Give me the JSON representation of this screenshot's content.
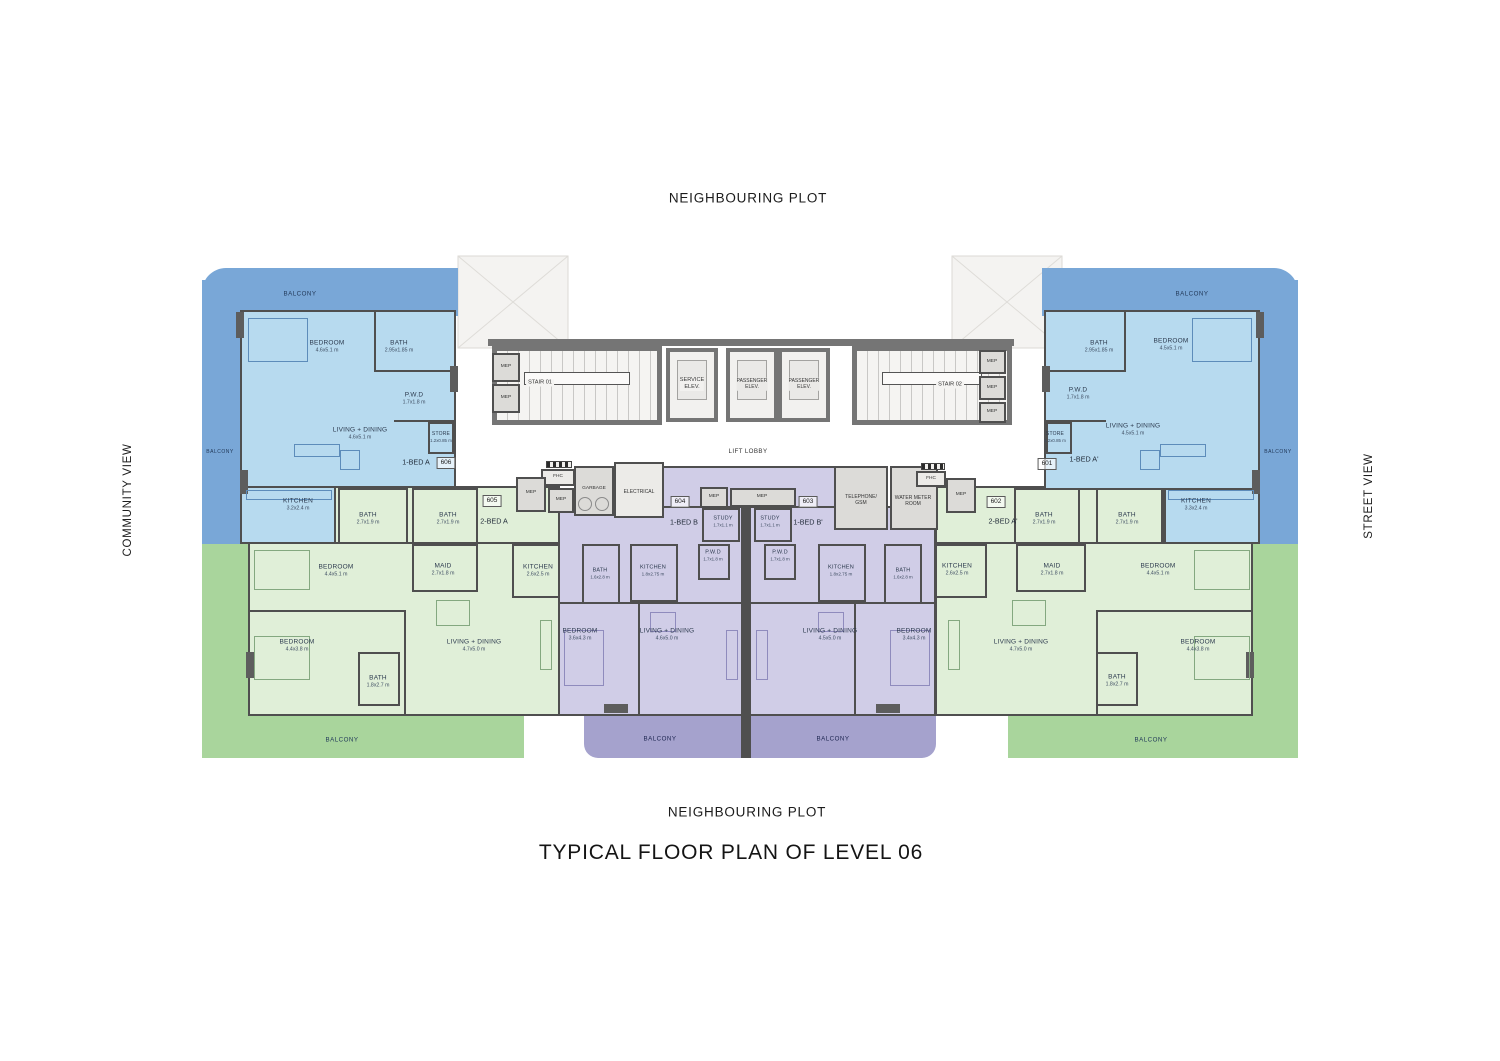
{
  "page": {
    "neighbouring_plot_top": "NEIGHBOURING PLOT",
    "neighbouring_plot_bottom": "NEIGHBOURING PLOT",
    "community_view": "COMMUNITY VIEW",
    "street_view": "STREET VIEW",
    "title": "TYPICAL FLOOR PLAN OF LEVEL 06"
  },
  "labels": {
    "balcony": "BALCONY"
  },
  "core": {
    "stair_01": "STAIR 01",
    "stair_02": "STAIR 02",
    "service_elev": "SERVICE\nELEV.",
    "passenger_elev": "PASSENGER\nELEV.",
    "lift_lobby": "LIFT LOBBY",
    "mep": "MEP",
    "fhc": "FHC",
    "garbage": "GARBAGE",
    "electrical": "ELECTRICAL",
    "telephone_gsm": "TELEPHONE/\nGSM",
    "water_meter_room": "WATER METER\nROOM"
  },
  "units": [
    {
      "number": "606",
      "name": "1-BED A",
      "rooms": [
        {
          "label": "BEDROOM",
          "dim": "4.6x5.1 m"
        },
        {
          "label": "BATH",
          "dim": "2.95x1.85 m"
        },
        {
          "label": "P.W.D",
          "dim": "1.7x1.8 m"
        },
        {
          "label": "LIVING + DINING",
          "dim": "4.6x5.1 m"
        },
        {
          "label": "STORE",
          "dim": "1.2x0.85 m"
        },
        {
          "label": "KITCHEN",
          "dim": "3.2x2.4 m"
        }
      ]
    },
    {
      "number": "605",
      "name": "2-BED A",
      "rooms": [
        {
          "label": "BATH",
          "dim": "2.7x1.9 m"
        },
        {
          "label": "BATH",
          "dim": "2.7x1.9 m"
        },
        {
          "label": "BEDROOM",
          "dim": "4.4x5.1 m"
        },
        {
          "label": "MAID",
          "dim": "2.7x1.8 m"
        },
        {
          "label": "KITCHEN",
          "dim": "2.6x2.5 m"
        },
        {
          "label": "BEDROOM",
          "dim": "4.4x3.8 m"
        },
        {
          "label": "BATH",
          "dim": "1.8x2.7 m"
        },
        {
          "label": "LIVING + DINING",
          "dim": "4.7x5.0 m"
        }
      ]
    },
    {
      "number": "604",
      "name": "1-BED B",
      "rooms": [
        {
          "label": "STUDY",
          "dim": "1.7x1.1 m"
        },
        {
          "label": "P.W.D",
          "dim": "1.7x1.8 m"
        },
        {
          "label": "KITCHEN",
          "dim": "1.8x2.75 m"
        },
        {
          "label": "BATH",
          "dim": "1.6x2.8 m"
        },
        {
          "label": "BEDROOM",
          "dim": "3.6x4.3 m"
        },
        {
          "label": "LIVING + DINING",
          "dim": "4.6x5.0 m"
        }
      ]
    },
    {
      "number": "603",
      "name": "1-BED B'",
      "rooms": [
        {
          "label": "STUDY",
          "dim": "1.7x1.1 m"
        },
        {
          "label": "P.W.D",
          "dim": "1.7x1.8 m"
        },
        {
          "label": "KITCHEN",
          "dim": "1.8x2.75 m"
        },
        {
          "label": "BATH",
          "dim": "1.6x2.8 m"
        },
        {
          "label": "BEDROOM",
          "dim": "3.4x4.3 m"
        },
        {
          "label": "LIVING + DINING",
          "dim": "4.5x5.0 m"
        }
      ]
    },
    {
      "number": "602",
      "name": "2-BED A'",
      "rooms": [
        {
          "label": "BATH",
          "dim": "2.7x1.9 m"
        },
        {
          "label": "BATH",
          "dim": "2.7x1.9 m"
        },
        {
          "label": "KITCHEN",
          "dim": "2.6x2.5 m"
        },
        {
          "label": "MAID",
          "dim": "2.7x1.8 m"
        },
        {
          "label": "BEDROOM",
          "dim": "4.4x5.1 m"
        },
        {
          "label": "LIVING + DINING",
          "dim": "4.7x5.0 m"
        },
        {
          "label": "BATH",
          "dim": "1.8x2.7 m"
        },
        {
          "label": "BEDROOM",
          "dim": "4.4x3.8 m"
        }
      ]
    },
    {
      "number": "601",
      "name": "1-BED A'",
      "rooms": [
        {
          "label": "BATH",
          "dim": "2.95x1.85 m"
        },
        {
          "label": "BEDROOM",
          "dim": "4.5x5.1 m"
        },
        {
          "label": "P.W.D",
          "dim": "1.7x1.8 m"
        },
        {
          "label": "STORE",
          "dim": "1.2x0.85 m"
        },
        {
          "label": "LIVING + DINING",
          "dim": "4.5x5.1 m"
        },
        {
          "label": "KITCHEN",
          "dim": "3.3x2.4 m"
        }
      ]
    }
  ],
  "colors": {
    "balcony_blue": "#79a7d7",
    "unit_blue": "#b7daef",
    "balcony_green": "#a9d59c",
    "unit_green": "#e0efd8",
    "balcony_purple": "#a5a2cd",
    "unit_purple": "#d0cde7",
    "wall": "#4f4f4f",
    "core_wall": "#757575",
    "service_fill": "#dcdbd8"
  }
}
